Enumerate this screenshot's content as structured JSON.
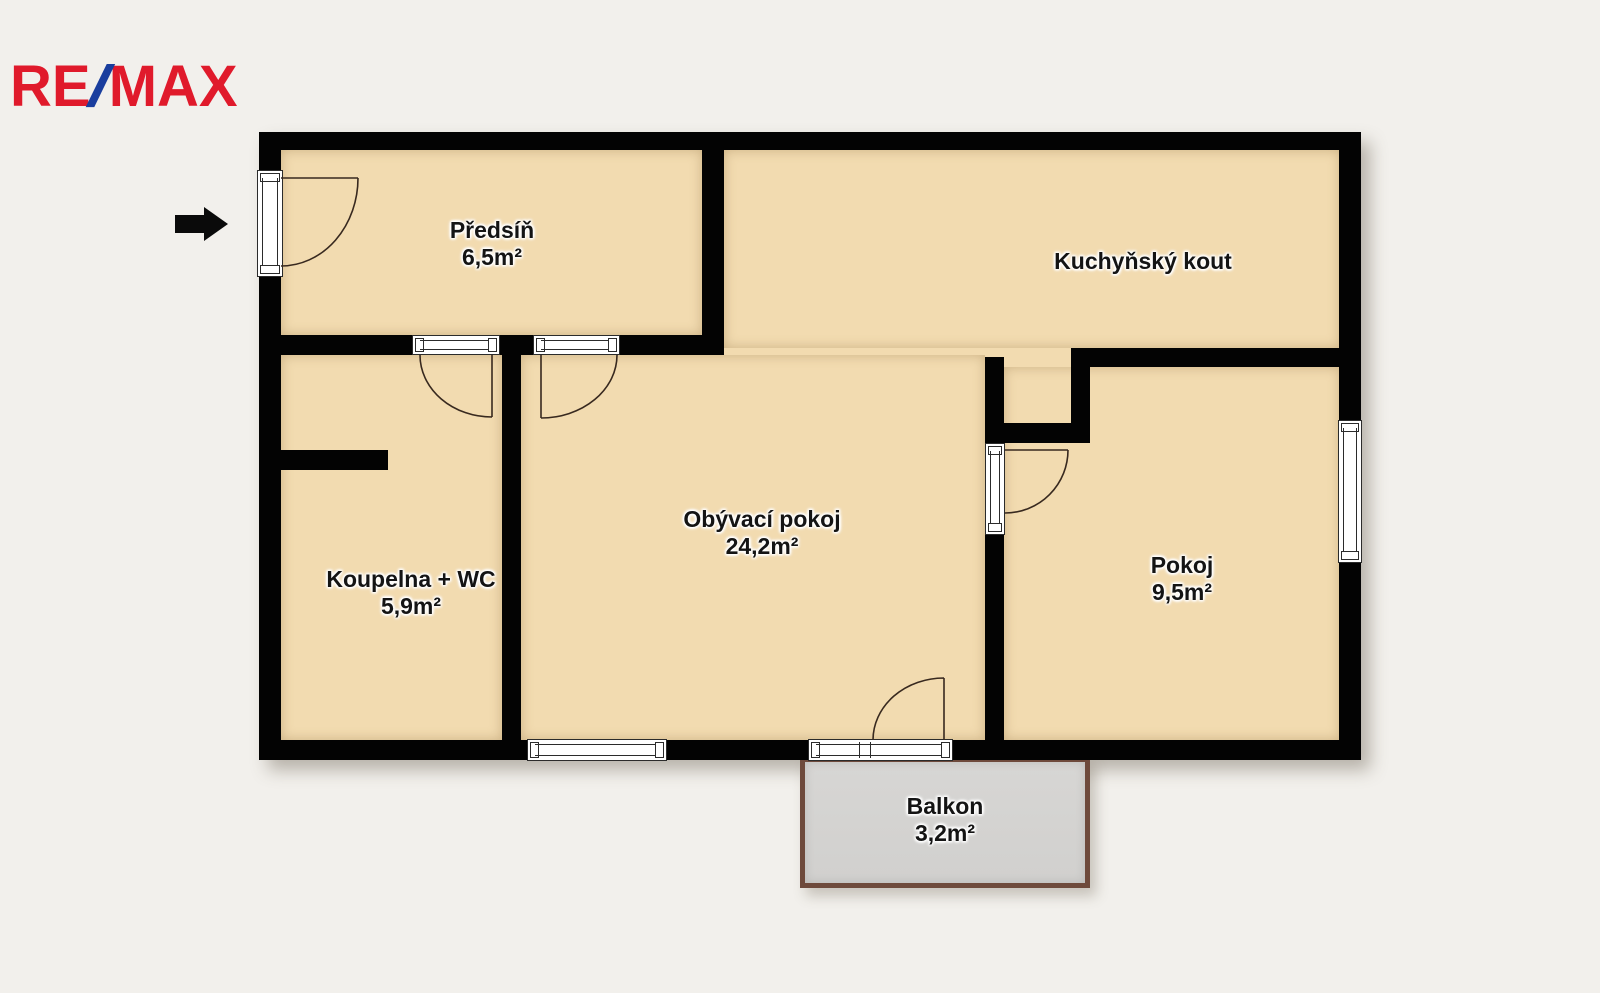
{
  "logo": {
    "re": "RE",
    "slash": "/",
    "max": "MAX"
  },
  "rooms": {
    "predsin": {
      "name": "Předsíň",
      "area": "6,5m²"
    },
    "kuchynsky_kout": {
      "name": "Kuchyňský kout"
    },
    "koupelna": {
      "name": "Koupelna + WC",
      "area": "5,9m²"
    },
    "obyvaci_pokoj": {
      "name": "Obývací pokoj",
      "area": "24,2m²"
    },
    "pokoj": {
      "name": "Pokoj",
      "area": "9,5m²"
    },
    "balkon": {
      "name": "Balkon",
      "area": "3,2m²"
    }
  },
  "icons": {
    "entrance_arrow": "right-arrow"
  },
  "colors": {
    "remax_red": "#e01a2b",
    "remax_blue": "#1a3e9e",
    "wall": "#030303",
    "room_fill": "#f2dbb0",
    "balcony_fill": "#d3d2d0",
    "balcony_border": "#6e4a3c",
    "background": "#f2f0ec"
  }
}
